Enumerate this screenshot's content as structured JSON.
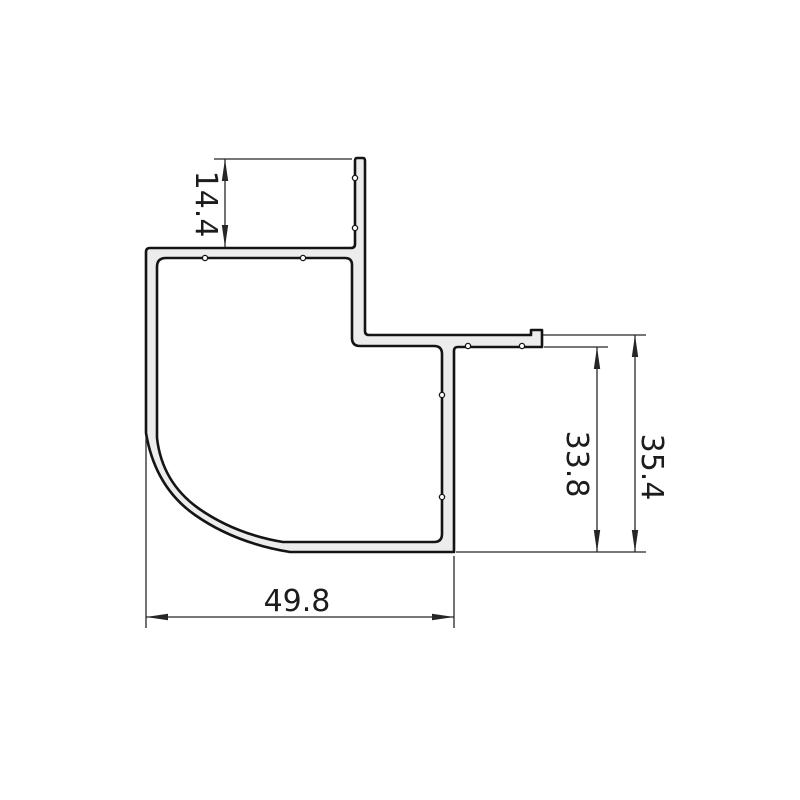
{
  "drawing": {
    "background": "#ffffff",
    "colors": {
      "profile_outline": "#141414",
      "profile_fill": "#ececec",
      "dimension_color": "#262626",
      "text_color": "#1c1c1c"
    },
    "dimensions": {
      "stem_height": {
        "value": "14.4",
        "orientation": "vertical"
      },
      "step_inner_height": {
        "value": "33.8",
        "orientation": "vertical"
      },
      "step_outer_height": {
        "value": "35.4",
        "orientation": "vertical"
      },
      "body_width": {
        "value": "49.8",
        "orientation": "horizontal"
      }
    }
  }
}
